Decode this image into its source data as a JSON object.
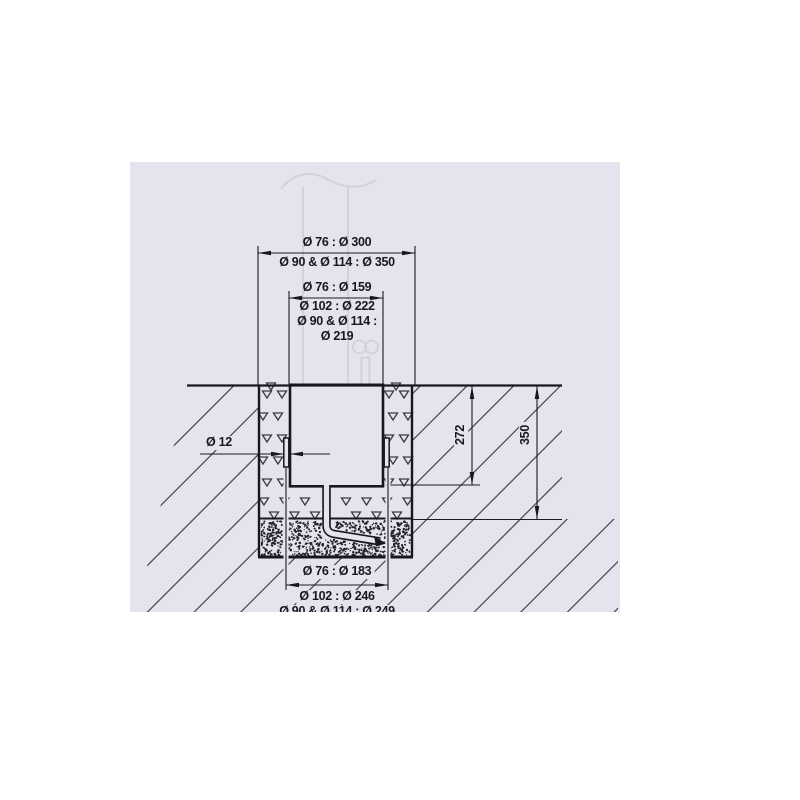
{
  "drawing": {
    "type": "technical-installation-cross-section",
    "colors": {
      "panel_background": "#e4e4ee",
      "line": "#17171c",
      "hatch": "#3b3b45",
      "ghost": "#d2d2db",
      "text": "#17171c"
    },
    "labels": {
      "top_width_row1": "Ø 76 : Ø 300",
      "top_width_row2": "Ø 90 & Ø 114 : Ø 350",
      "sleeve_width_row1": "Ø 76 : Ø 159",
      "sleeve_width_row2": "Ø 102 : Ø 222",
      "sleeve_width_row3": "Ø 90 & Ø 114 :",
      "sleeve_width_row4": "Ø 219",
      "wall_thickness": "Ø 12",
      "depth_sleeve": "272",
      "depth_pit": "350",
      "bottom_width_row1": "Ø 76 : Ø 183",
      "bottom_width_row2": "Ø 102 : Ø 246",
      "bottom_width_row3": "Ø 90 & Ø 114 : Ø 249"
    }
  }
}
